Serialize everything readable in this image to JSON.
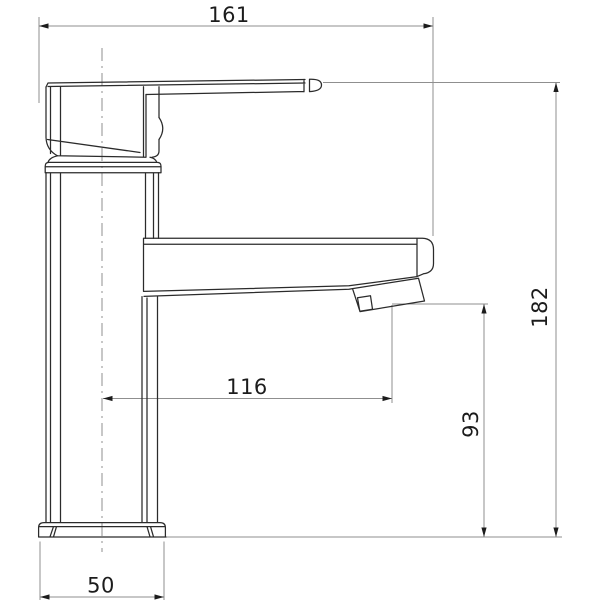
{
  "diagram": {
    "dimensions": {
      "overall_width": "161",
      "overall_height": "182",
      "spout_reach": "116",
      "outlet_height": "93",
      "base_width": "50"
    },
    "colors": {
      "outline": "#2b2b2b",
      "dimension_lines": "#8f8f8f",
      "dimension_text": "#1c1c1c",
      "background": "#ffffff"
    }
  }
}
